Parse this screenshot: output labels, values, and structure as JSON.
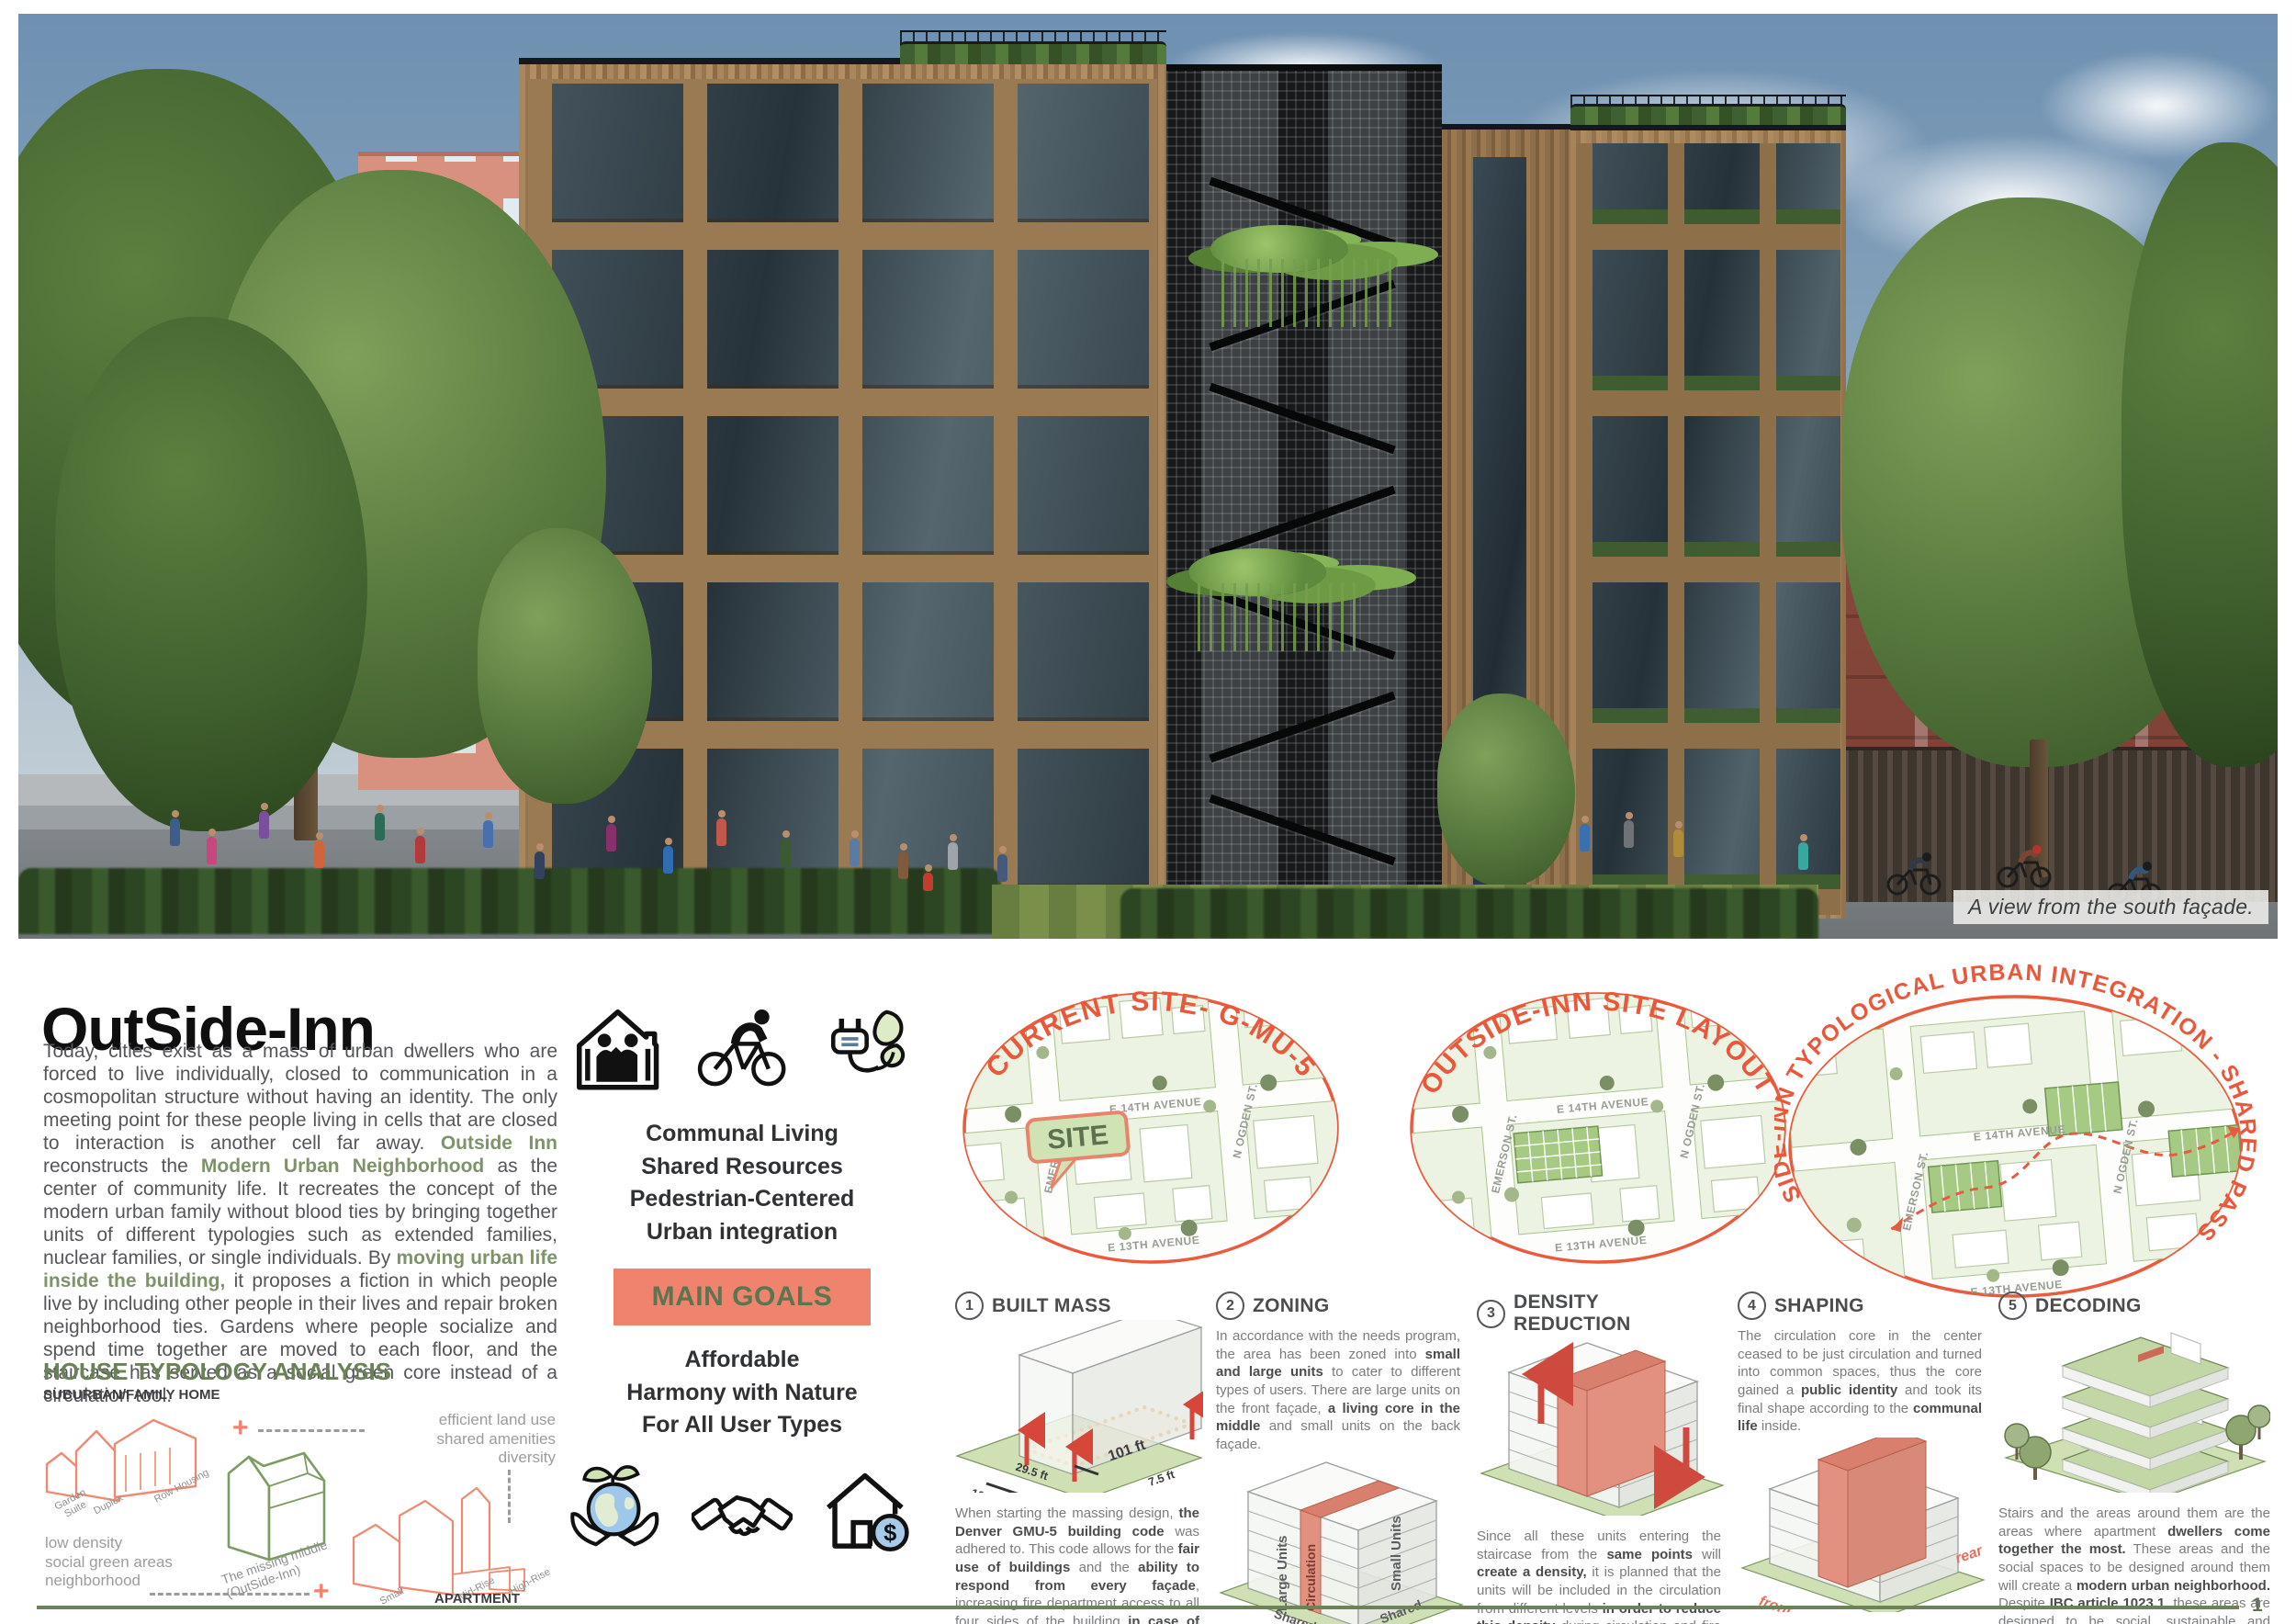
{
  "page": {
    "number": "1"
  },
  "photo": {
    "caption": "A view from the south façade."
  },
  "intro": {
    "title": "OutSide-Inn",
    "paragraph": [
      {
        "t": "Today, cities exist as a mass of urban dwellers who are forced to live individually, closed to communication in a cosmopolitan structure without having an identity. The only meeting point for these people living in cells that are closed to interaction is another cell far away. "
      },
      {
        "t": "Outside Inn",
        "s": "g"
      },
      {
        "t": " reconstructs the "
      },
      {
        "t": "Modern Urban Neighborhood",
        "s": "g"
      },
      {
        "t": " as the center of community life. It recreates the concept of the modern urban family without blood ties by bringing together units of different typologies such as extended families, nuclear families, or single individuals. By "
      },
      {
        "t": "moving urban life inside the building,",
        "s": "g"
      },
      {
        "t": " it proposes a fiction in which people live by including other people in their lives and repair broken neighborhood ties. Gardens where people socialize and spend time together are moved to each floor, and the staircase has served as a social green core instead of a circulation tool."
      }
    ]
  },
  "typology": {
    "heading": "HOUSE TYPOLOGY ANALYSIS",
    "sub": "SUBURBAN/FAMILY HOME",
    "right_note": "efficient land use\nshared amenities\ndiversity",
    "left_note": "low density\nsocial green areas\nneighborhood",
    "middle_label": "The missing middle\n(OutSide-Inn)",
    "apartment_label": "APARTMENT",
    "house_labels": [
      "Garden\nSuite",
      "Duplex",
      "Row Housing"
    ],
    "apt_labels": [
      "Small",
      "Mid-Rise",
      "High-Rise"
    ]
  },
  "goals": {
    "line1": "Communal Living",
    "line2": "Shared Resources",
    "line3": "Pedestrian-Centered",
    "line4": "Urban integration",
    "banner": "MAIN GOALS",
    "line5": "Affordable",
    "line6": "Harmony with Nature",
    "line7": "For All User Types"
  },
  "maps": {
    "c1": {
      "title": "CURRENT SITE- G-MU-5",
      "site_label": "SITE"
    },
    "c2": {
      "title": "OUTSIDE-INN SITE LAYOUT"
    },
    "c3": {
      "title": "OUTSIDE-INN TYPOLOGICAL URBAN INTEGRATION - SHARED PASSAGE"
    },
    "streets": {
      "h1": "E 14TH AVENUE",
      "h2": "E 13TH AVENUE",
      "v1": "EMERSON ST.",
      "v2": "N OGDEN ST."
    }
  },
  "process": {
    "steps": [
      {
        "num": "1",
        "title": "BUILT MASS",
        "dims": {
          "w": "101 ft",
          "h": "29.5 ft",
          "s1": "7.5 ft",
          "s2": "10 ft"
        },
        "body": [
          {
            "t": "When starting the massing design, "
          },
          {
            "t": "the Denver GMU-5 building code",
            "s": "b"
          },
          {
            "t": " was adhered to.  This code allows for the "
          },
          {
            "t": "fair use of buildings",
            "s": "b"
          },
          {
            "t": " and the "
          },
          {
            "t": "ability to respond from every façade",
            "s": "b"
          },
          {
            "t": ", increasing fire department access to all four sides of the building "
          },
          {
            "t": "in case of emergency",
            "s": "b"
          },
          {
            "t": ". After the setback distances were implemented, the remaining space was used to implement a modular system."
          }
        ]
      },
      {
        "num": "2",
        "title": "ZONING",
        "labels": {
          "large": "Large Units",
          "circ": "Circulation",
          "small": "Small Units",
          "shared1": "Shared",
          "shared2": "Shared"
        },
        "body": [
          {
            "t": "In accordance with the needs program, the area has been zoned into "
          },
          {
            "t": "small and large units",
            "s": "b"
          },
          {
            "t": " to cater to different types of users. There are large units on the front façade, "
          },
          {
            "t": "a living core in the middle",
            "s": "b"
          },
          {
            "t": " and small units on the back façade."
          }
        ]
      },
      {
        "num": "3",
        "title": "DENSITY REDUCTION",
        "body": [
          {
            "t": "Since all these units entering the staircase from the "
          },
          {
            "t": "same points",
            "s": "b"
          },
          {
            "t": " will "
          },
          {
            "t": "create a density,",
            "s": "b"
          },
          {
            "t": " it is planned that the units will be included in the circulation from different levels "
          },
          {
            "t": "in order to reduce this density",
            "s": "b"
          },
          {
            "t": " during circulation and fire escape."
          }
        ]
      },
      {
        "num": "4",
        "title": "SHAPING",
        "front": "front",
        "rear": "rear",
        "body": [
          {
            "t": "The circulation core in the center ceased to be just circulation and turned into common spaces, thus the core gained a "
          },
          {
            "t": "public identity",
            "s": "b"
          },
          {
            "t": " and took its final shape according to the "
          },
          {
            "t": "communal life",
            "s": "b"
          },
          {
            "t": " inside."
          }
        ]
      },
      {
        "num": "5",
        "title": "DECODING",
        "body": [
          {
            "t": "Stairs and the areas around them are the areas where apartment "
          },
          {
            "t": "dwellers come together the most.",
            "s": "b"
          },
          {
            "t": " These areas and the social spaces to be designed around them will create a "
          },
          {
            "t": "modern urban neighborhood.",
            "s": "b"
          },
          {
            "t": " Despite "
          },
          {
            "t": "IBC article 1023.1",
            "s": "b"
          },
          {
            "t": ", these areas are designed to be social, sustainable and affordable."
          }
        ]
      }
    ]
  },
  "colors": {
    "accent_red": "#e9583a",
    "accent_salmon": "#f0836e",
    "accent_green": "#6b8157",
    "wood": "#a8875f"
  }
}
